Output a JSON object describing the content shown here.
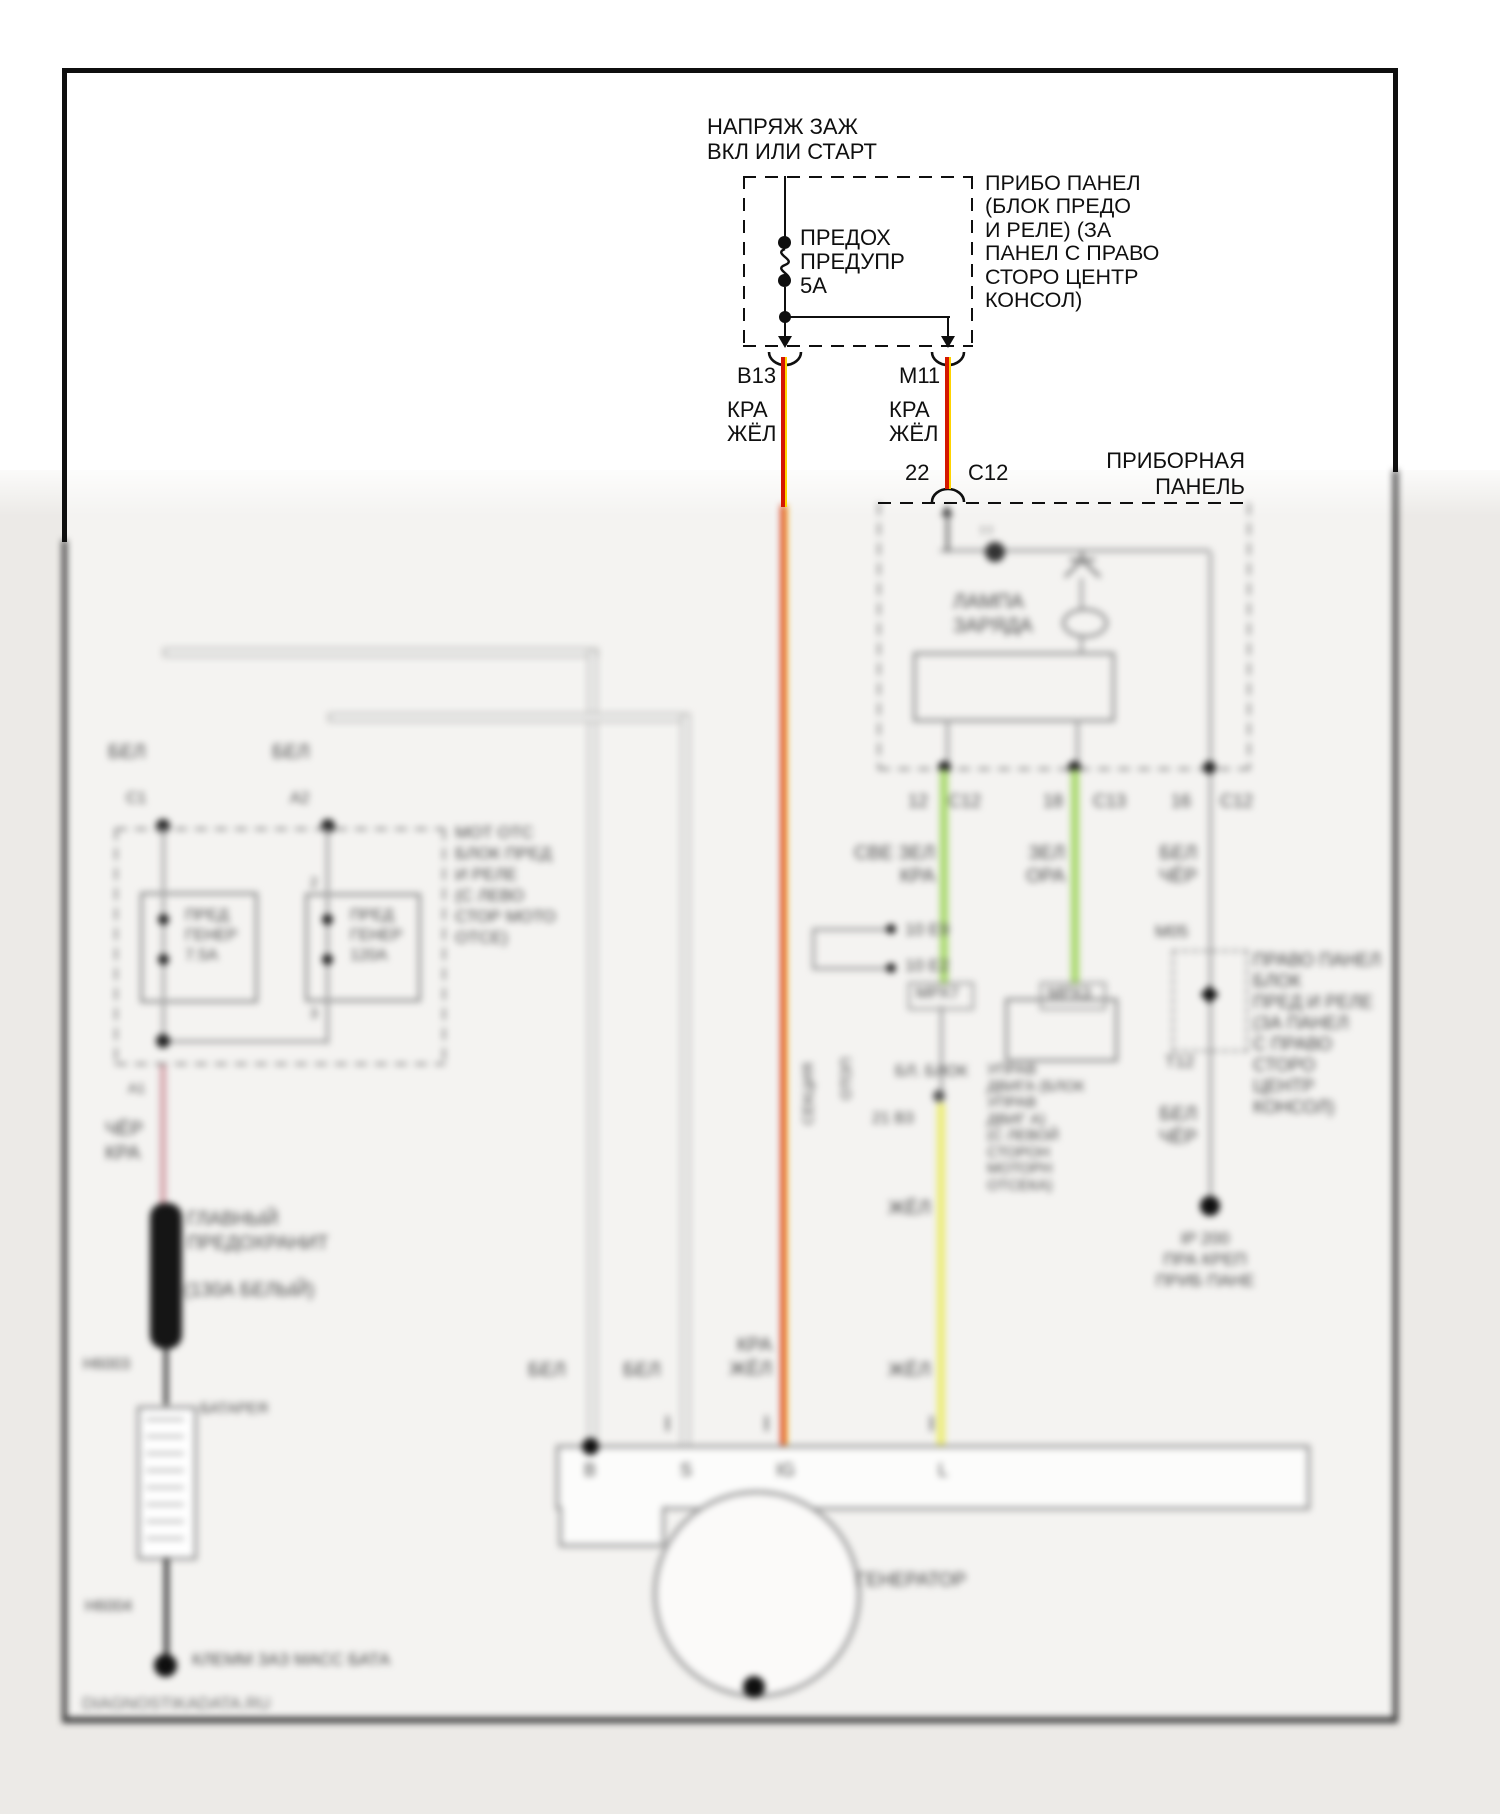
{
  "diagram": {
    "power_title": [
      "НАПРЯЖ ЗАЖ",
      "ВКЛ ИЛИ СТАРТ"
    ],
    "fuse_label": [
      "ПРЕДОХ",
      "ПРЕДУПР",
      "5А"
    ],
    "fusebox_note": [
      "ПРИБО ПАНЕЛ",
      "(БЛОК ПРЕДО",
      "И РЕЛЕ) (ЗА",
      "ПАНЕЛ С ПРАВО",
      "СТОРО ЦЕНТР",
      "КОНСОЛ)"
    ],
    "pin_b13": "B13",
    "pin_m11": "M11",
    "wire_b13_colors": [
      "КРА",
      "ЖЁЛ"
    ],
    "wire_m11_colors": [
      "КРА",
      "ЖЁЛ"
    ],
    "panel_pin": "22",
    "panel_conn": "C12",
    "panel_title": [
      "ПРИБОРНАЯ",
      "ПАНЕЛЬ"
    ]
  },
  "blurred": {
    "charge_lamp": [
      "ЛАМПА",
      "ЗАРЯДА"
    ],
    "panel_pins": {
      "p1": "12",
      "c1": "С12",
      "p2": "18",
      "c2": "С13",
      "p3": "16",
      "c3": "С12"
    },
    "green1_colors": [
      "СВЕ ЗЕЛ",
      "КРА"
    ],
    "green2_colors": [
      "ЗЕЛ",
      "ОРА"
    ],
    "gray_colors_top": [
      "БЕЛ",
      "ЧЁР"
    ],
    "gray_colors_bottom": [
      "БЕЛ",
      "ЧЁР"
    ],
    "mrx7": "МРХ7",
    "mrx3": "МРХ3",
    "jumper_pins": [
      "10  Е9",
      "10  Е2"
    ],
    "section_label": "СЕКЦИЯ",
    "section_label2": "ОТОП",
    "block_label": "БЛ. БЛОК",
    "yellow_pin": "21  В3",
    "ecm_note": [
      "УПРАВ",
      "ДВИГА (БЛОК",
      "УПРАВ",
      "ДВИГ А)",
      "(С ЛЕВОЙ",
      "СТОРОН",
      "МОТОРН",
      "ОТСЕКА)"
    ],
    "right_panel_note": [
      "ПРАВО ПАНЕЛ",
      "БЛОК",
      "ПРЕД И РЕЛЕ",
      "(ЗА ПАНЕЛ",
      "С ПРАВО",
      "СТОРО",
      "ЦЕНТР",
      "КОНСОЛ)"
    ],
    "m05": "М05",
    "t12": "Т12",
    "ip_ground": [
      "IP 200",
      "ПРА КРЕП",
      "ПРИБ ПАНЕ"
    ],
    "bel_left": "БЕЛ",
    "bel_right": "БЕЛ",
    "conn_c1": "С1",
    "conn_a2": "А2",
    "engine_box_note": [
      "МОТ ОТС",
      "БЛОК ПРЕД",
      "И РЕЛЕ",
      "(С ЛЕВО",
      "СТОР МОТО",
      "ОТСЕ)"
    ],
    "fuse_gen1": [
      "ПРЕД",
      "ГЕНЕР",
      "7.5А"
    ],
    "fuse_gen2": [
      "ПРЕД",
      "ГЕНЕР",
      "120А"
    ],
    "pin2": "2",
    "pin3": "3",
    "pin_a1": "А1",
    "wire_black_red": [
      "ЧЁР",
      "КРА"
    ],
    "main_fuse": [
      "ГЛАВНЫЙ",
      "ПРЕДОХРАНИТ"
    ],
    "main_fuse_rating": "(130А БЕЛЫЙ)",
    "g_h6003": "Н6003",
    "battery_label": "БАТАРЕЯ",
    "g_h6004": "Н6004",
    "battery_ground": "КЛЕММ ЗАЗ МАСС БАТА",
    "watermark": "DIAGNOSTIKADATA.RU",
    "strip_bel1": "БЕЛ",
    "strip_bel2": "БЕЛ",
    "strip_kra_zhel": [
      "КРА",
      "ЖЁЛ"
    ],
    "zhel_top": "ЖЁЛ",
    "zhel_bottom": "ЖЁЛ",
    "gen_pins": {
      "b": "B",
      "s": "S",
      "ig": "IG",
      "l": "L"
    },
    "generator_label": "ГЕНЕРАТОР"
  },
  "colors": {
    "wire_red": "#d41800",
    "wire_yellow_stripe": "#ffd400",
    "wire_green": "#a7d96b",
    "wire_yellow": "#ecec74",
    "wire_white": "#fcfcfb",
    "wire_gray": "#9b9b9b",
    "wire_pink": "#d3a2a9",
    "frame": "#0f0f0f",
    "lower_wash": "#eceae7"
  }
}
